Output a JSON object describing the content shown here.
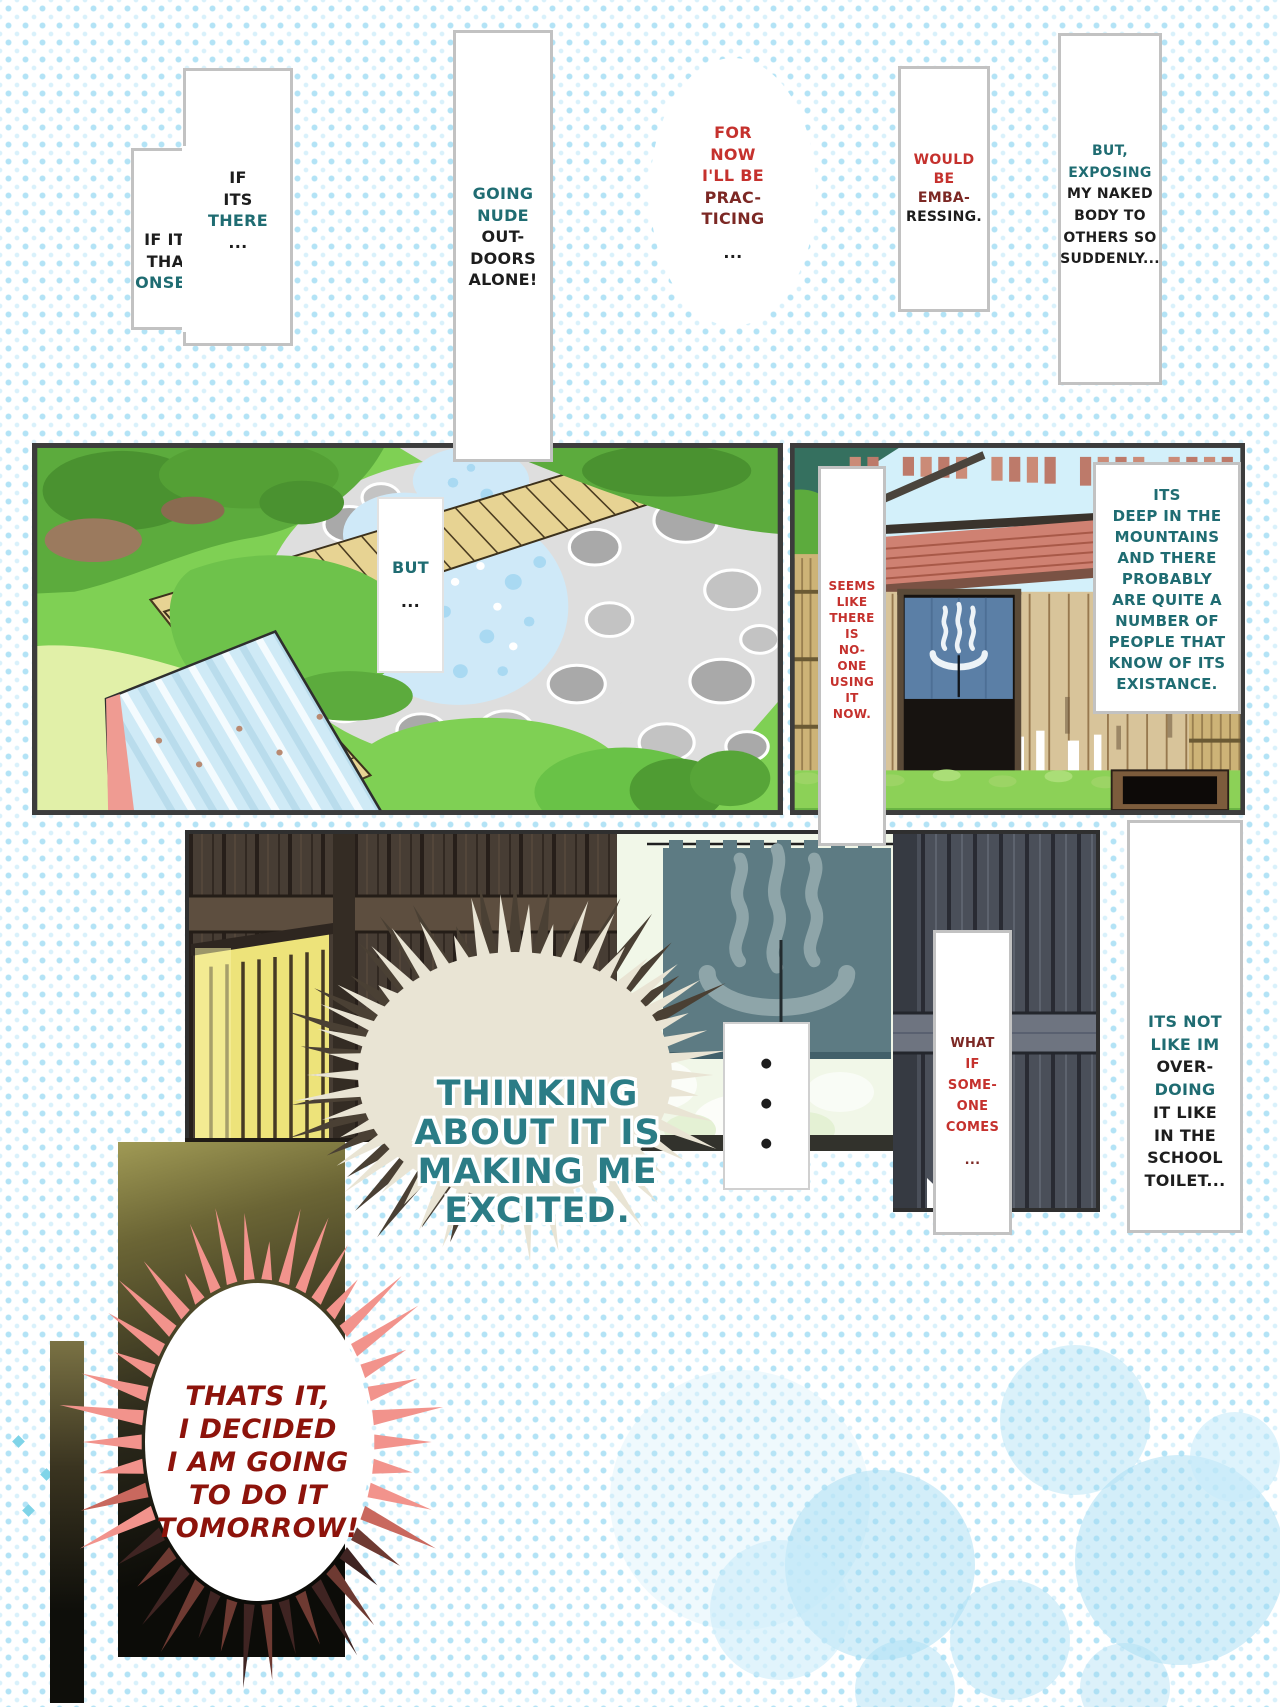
{
  "palette": {
    "halftone_dot": "#aee2f6",
    "panel_border": "#3c3c3c",
    "bubble_border": "#c2c2c2",
    "text_black": "#1d1d1d",
    "text_teal": "#1f6c72",
    "text_red": "#c5312d",
    "text_maroon": "#7c2824",
    "caption_teal": "#2b7c86",
    "caption_dark_red": "#8d130b",
    "noren_blue": "#5b7fa6",
    "noren_teal": "#5d7b83",
    "burst_pink": "#f2938c",
    "burst_cream": "#e9e4d4"
  },
  "icons": {
    "onsen_symbol": "hot-spring-mark"
  },
  "bubbles": {
    "if_that_onsen": {
      "lines": [
        {
          "t": "IF ITS",
          "c": "black"
        },
        {
          "t": "THAT",
          "c": "black"
        },
        {
          "t": "ONSEN.",
          "c": "teal"
        }
      ]
    },
    "if_its_there": {
      "lines": [
        {
          "t": "IF",
          "c": "black"
        },
        {
          "t": "ITS",
          "c": "black"
        },
        {
          "t": "THERE",
          "c": "teal"
        },
        {
          "t": "...",
          "c": "black"
        }
      ]
    },
    "going_nude": {
      "lines": [
        {
          "t": "GOING",
          "c": "teal"
        },
        {
          "t": "NUDE",
          "c": "teal"
        },
        {
          "t": "OUT-",
          "c": "black"
        },
        {
          "t": "DOORS",
          "c": "black"
        },
        {
          "t": "ALONE!",
          "c": "black"
        }
      ]
    },
    "for_now": {
      "lines": [
        {
          "t": "FOR",
          "c": "red"
        },
        {
          "t": "NOW",
          "c": "red"
        },
        {
          "t": "I'LL BE",
          "c": "red"
        },
        {
          "t": "PRAC-",
          "c": "maroon"
        },
        {
          "t": "TICING",
          "c": "maroon"
        },
        {
          "t": "...",
          "c": "black"
        }
      ]
    },
    "would_be": {
      "lines": [
        {
          "t": "WOULD",
          "c": "red"
        },
        {
          "t": "BE",
          "c": "red"
        },
        {
          "t": "EMBA-",
          "c": "maroon"
        },
        {
          "t": "RESSING.",
          "c": "black"
        }
      ]
    },
    "but_exposing": {
      "lines": [
        {
          "t": "BUT,",
          "c": "teal"
        },
        {
          "t": "EXPOSING",
          "c": "teal"
        },
        {
          "t": "MY NAKED",
          "c": "black"
        },
        {
          "t": "BODY TO",
          "c": "black"
        },
        {
          "t": "OTHERS SO",
          "c": "black"
        },
        {
          "t": "SUDDENLY...",
          "c": "black"
        }
      ]
    },
    "but_ellipsis": {
      "lines": [
        {
          "t": "BUT",
          "c": "teal"
        },
        {
          "t": "...",
          "c": "black"
        }
      ]
    },
    "seems_like": {
      "lines": [
        {
          "t": "SEEMS",
          "c": "red"
        },
        {
          "t": "LIKE",
          "c": "red"
        },
        {
          "t": "THERE",
          "c": "red"
        },
        {
          "t": "IS",
          "c": "red"
        },
        {
          "t": "NO-",
          "c": "red"
        },
        {
          "t": "ONE",
          "c": "red"
        },
        {
          "t": "USING",
          "c": "red"
        },
        {
          "t": "IT",
          "c": "red"
        },
        {
          "t": "NOW.",
          "c": "red"
        }
      ]
    },
    "its_deep": {
      "lines": [
        {
          "t": "ITS",
          "c": "teal"
        },
        {
          "t": "DEEP IN THE",
          "c": "teal"
        },
        {
          "t": "MOUNTAINS",
          "c": "teal"
        },
        {
          "t": "AND THERE",
          "c": "teal"
        },
        {
          "t": "PROBABLY",
          "c": "teal"
        },
        {
          "t": "ARE QUITE A",
          "c": "teal"
        },
        {
          "t": "NUMBER OF",
          "c": "teal"
        },
        {
          "t": "PEOPLE THAT",
          "c": "teal"
        },
        {
          "t": "KNOW OF ITS",
          "c": "teal"
        },
        {
          "t": "EXISTANCE.",
          "c": "teal"
        }
      ]
    },
    "silence_dots": {
      "lines": [
        {
          "t": "●",
          "c": "black"
        },
        {
          "t": "●",
          "c": "black"
        },
        {
          "t": "●",
          "c": "black"
        }
      ]
    },
    "what_if": {
      "lines": [
        {
          "t": "WHAT",
          "c": "maroon"
        },
        {
          "t": "IF",
          "c": "red"
        },
        {
          "t": "SOME-",
          "c": "red"
        },
        {
          "t": "ONE",
          "c": "red"
        },
        {
          "t": "COMES",
          "c": "red"
        },
        {
          "t": "...",
          "c": "maroon"
        }
      ]
    },
    "its_not": {
      "lines": [
        {
          "t": "ITS NOT",
          "c": "teal"
        },
        {
          "t": "LIKE IM",
          "c": "teal"
        },
        {
          "t": "OVER-",
          "c": "black"
        },
        {
          "t": "DOING",
          "c": "teal"
        },
        {
          "t": "IT LIKE",
          "c": "black"
        },
        {
          "t": "IN THE",
          "c": "black"
        },
        {
          "t": "SCHOOL",
          "c": "black"
        },
        {
          "t": "TOILET...",
          "c": "black"
        }
      ]
    }
  },
  "captions": {
    "thinking": {
      "lines": [
        {
          "t": "THINKING",
          "c": "cap-teal"
        },
        {
          "t": "ABOUT IT IS",
          "c": "cap-teal"
        },
        {
          "t": "MAKING ME",
          "c": "cap-teal"
        },
        {
          "t": "EXCITED.",
          "c": "cap-teal"
        }
      ]
    },
    "thats_it": {
      "lines": [
        {
          "t": "THATS IT,",
          "c": "cap-dark-red"
        },
        {
          "t": "I DECIDED",
          "c": "cap-dark-red"
        },
        {
          "t": "I AM GOING",
          "c": "cap-dark-red"
        },
        {
          "t": "TO DO IT",
          "c": "cap-dark-red"
        },
        {
          "t": "TOMORROW!",
          "c": "cap-dark-red"
        }
      ]
    }
  }
}
